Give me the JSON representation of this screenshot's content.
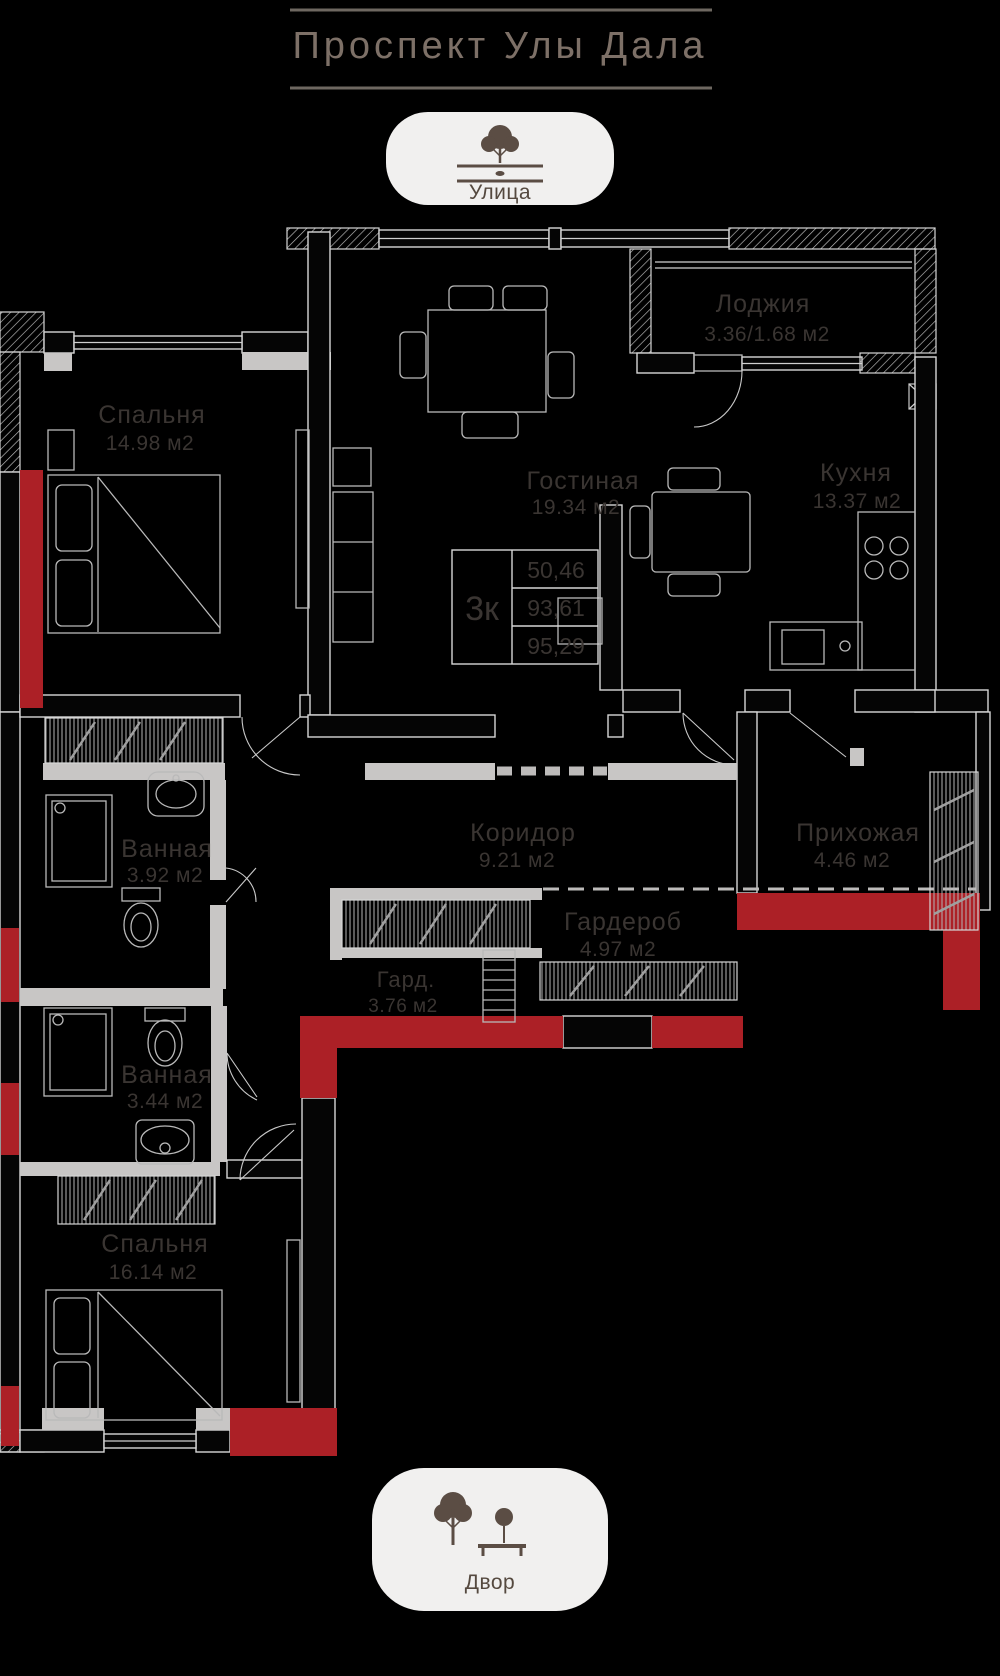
{
  "header": {
    "title": "Проспект Улы Дала"
  },
  "badges": {
    "street": {
      "label": "Улица"
    },
    "yard": {
      "label": "Двор"
    }
  },
  "plan": {
    "unit_table": {
      "rooms_label": "3к",
      "values": [
        "50,46",
        "93,61",
        "95,29"
      ]
    },
    "rooms": {
      "loggia": {
        "name": "Лоджия",
        "area": "3.36/1.68 м2"
      },
      "bedroom1": {
        "name": "Спальня",
        "area": "14.98 м2"
      },
      "living": {
        "name": "Гостиная",
        "area": "19.34 м2"
      },
      "kitchen": {
        "name": "Кухня",
        "area": "13.37 м2"
      },
      "bath1": {
        "name": "Ванная",
        "area": "3.92 м2"
      },
      "corridor": {
        "name": "Коридор",
        "area": "9.21 м2"
      },
      "hallway": {
        "name": "Прихожая",
        "area": "4.46 м2"
      },
      "wardrobe": {
        "name": "Гардероб",
        "area": "4.97 м2"
      },
      "wardrobe_small": {
        "name": "Гард.",
        "area": "3.76 м2"
      },
      "bath2": {
        "name": "Ванная",
        "area": "3.44 м2"
      },
      "bedroom2": {
        "name": "Спальня",
        "area": "16.14 м2"
      }
    },
    "colors": {
      "accent_red": "#ac2026",
      "partition_gray": "#c8c6c5",
      "wall_line": "#d6d6d6",
      "label_text": "#3a3532",
      "title_text": "#7d7067",
      "badge_bg": "#f1f0ef",
      "badge_text": "#55493f",
      "background": "#000000"
    }
  }
}
